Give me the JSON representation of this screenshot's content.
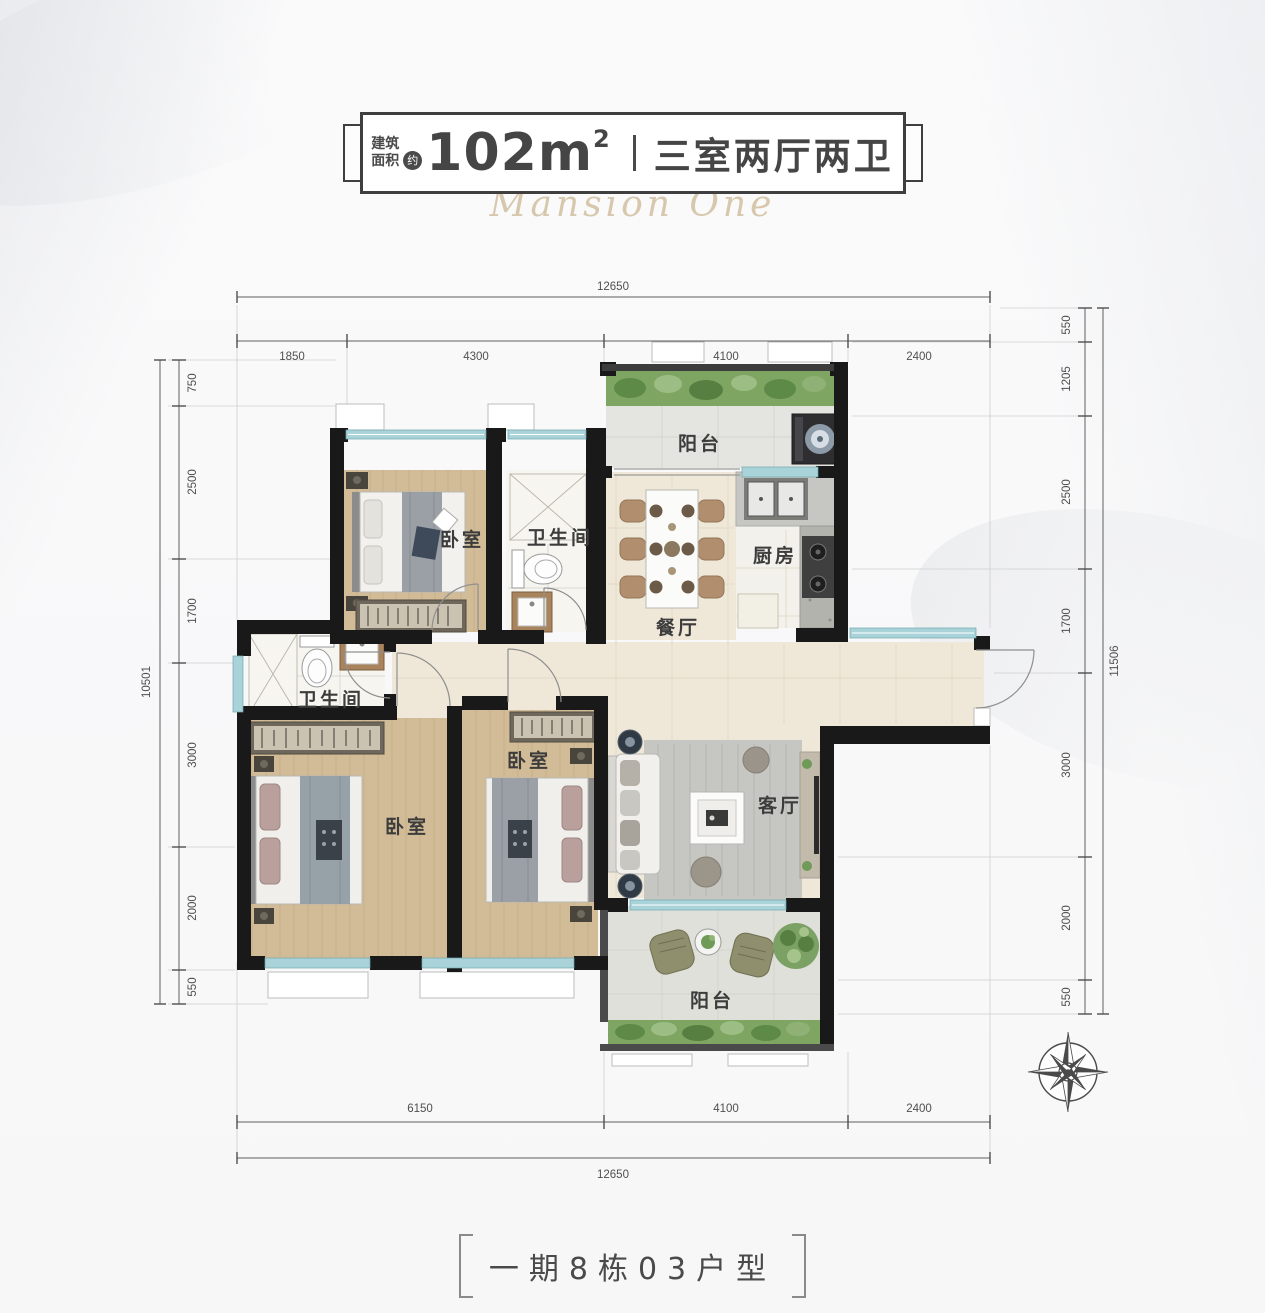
{
  "title_badge": {
    "area_prefix_line1": "建筑",
    "area_prefix_line2": "面积",
    "approx": "约",
    "area_value": "102m",
    "area_exponent": "2",
    "layout_summary": "三室两厅两卫",
    "watermark": "Mansion One"
  },
  "plan": {
    "rooms": {
      "balcony_top": "阳台",
      "bedroom_top": "卧室",
      "bathroom_top": "卫生间",
      "kitchen": "厨房",
      "dining": "餐厅",
      "bathroom_left": "卫生间",
      "bedroom_master": "卧室",
      "bedroom_middle": "卧室",
      "living": "客厅",
      "balcony_bottom": "阳台"
    },
    "dimensions": {
      "top": {
        "overall": "12650",
        "segments": [
          "1850",
          "4300",
          "4100",
          "2400"
        ]
      },
      "bottom": {
        "overall": "12650",
        "segments": [
          "6150",
          "4100",
          "2400"
        ]
      },
      "left": {
        "overall": "10501",
        "segments": [
          "750",
          "2500",
          "1700",
          "3000",
          "2000",
          "550"
        ]
      },
      "right": {
        "overall": "11506",
        "segments": [
          "550",
          "1205",
          "2500",
          "1700",
          "3000",
          "2000",
          "550"
        ]
      }
    }
  },
  "footer": {
    "unit_label": "一期8栋03户型"
  },
  "colors": {
    "wall": "#191919",
    "window_glass": "#a9d3d8",
    "wood_floor": "#d2bc97",
    "tile_floor": "#efe8d8",
    "balcony_tile": "#e4e4e0",
    "plants": "#79a261",
    "text_primary": "#454545",
    "dimension_text": "#4f4f4f"
  }
}
